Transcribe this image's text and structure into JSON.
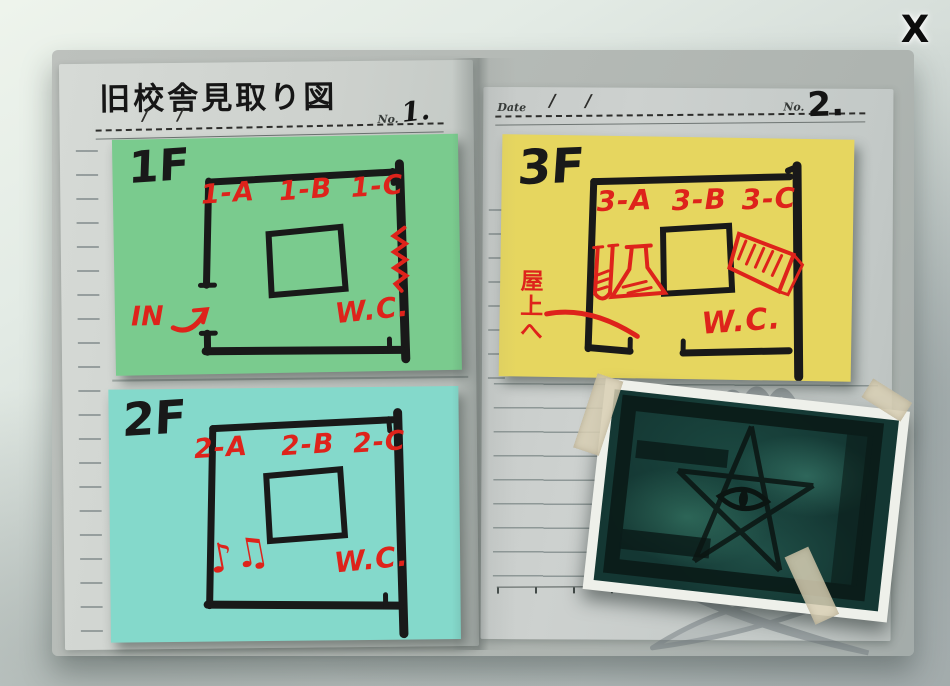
{
  "close_button": {
    "label": "X"
  },
  "left_page": {
    "title": "旧校舎見取り図",
    "date_slashes": [
      "/",
      "/"
    ],
    "no_label": "No.",
    "page_no": "1."
  },
  "right_page": {
    "date_label": "Date",
    "date_slashes": [
      "/",
      "/"
    ],
    "no_label": "No.",
    "page_no": "2."
  },
  "floors": {
    "f1": {
      "label": "1F",
      "rooms": [
        "1-A",
        "1-B",
        "1-C"
      ],
      "in_label": "IN",
      "wc_label": "W.C.",
      "note_color": "#7acb8e"
    },
    "f2": {
      "label": "2F",
      "rooms": [
        "2-A",
        "2-B",
        "2-C"
      ],
      "music_notes": "♪♫",
      "wc_label": "W.C.",
      "note_color": "#84d9cb"
    },
    "f3": {
      "label": "3F",
      "rooms": [
        "3-A",
        "3-B",
        "3-C"
      ],
      "roof_label": "屋上へ",
      "wc_label": "W.C.",
      "note_color": "#e6d65f"
    }
  },
  "ink_colors": {
    "marker_black": "#191919",
    "marker_red": "#de231b"
  },
  "photo": {
    "base_color": "#143733"
  },
  "icons": {
    "stairs": "zigzag-scribble",
    "entrance": "curved-arrow",
    "science_room": "flask-and-test-tube-sketch",
    "library": "book-sketch",
    "music_room": "eighth-notes",
    "photo_subject": "pentagram-eye-graffiti",
    "watermark": "school-emblem"
  }
}
